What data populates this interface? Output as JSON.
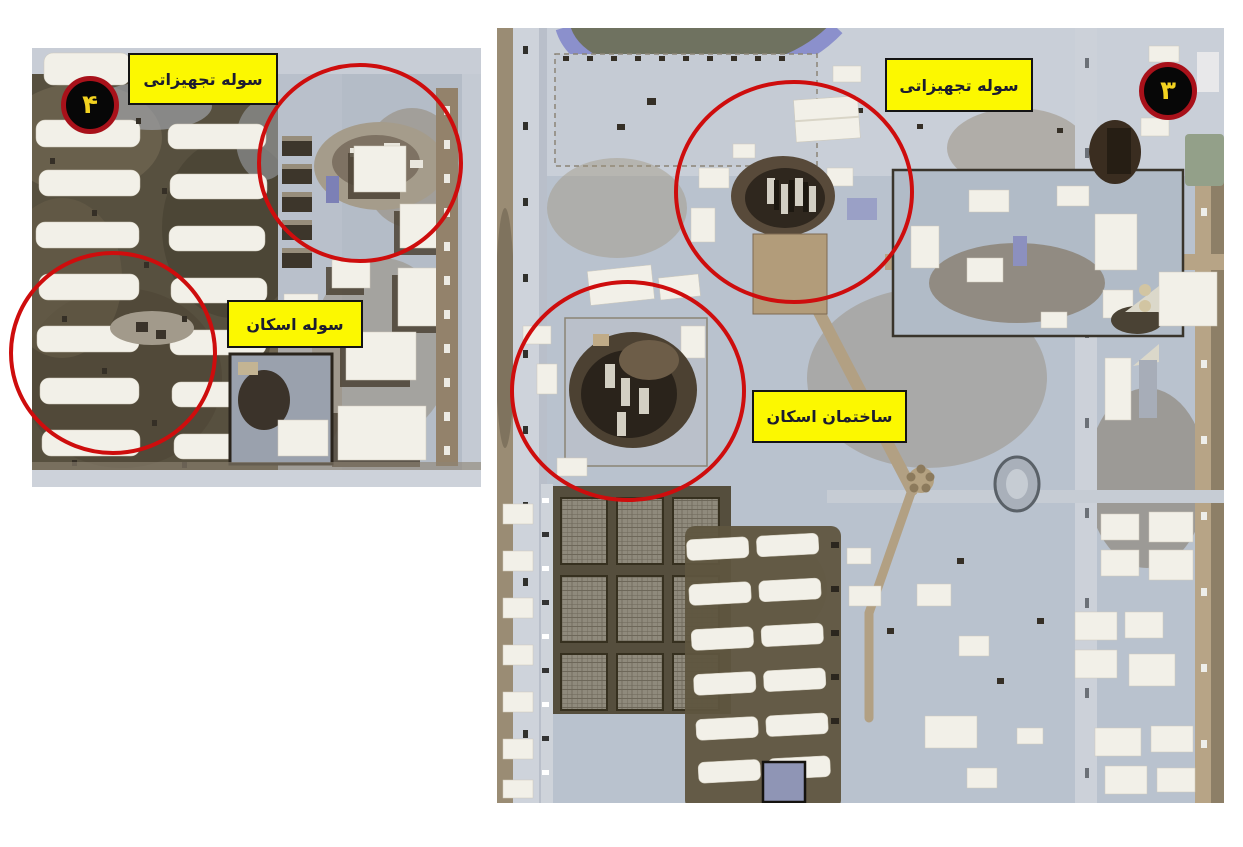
{
  "page": {
    "title": "Annotated satellite imagery of struck base facilities",
    "background": "#ffffff"
  },
  "panels": {
    "left": {
      "marker": {
        "number": "۴"
      },
      "labels": [
        {
          "text": "سوله تجهیزاتی"
        },
        {
          "text": "سوله اسکان"
        }
      ]
    },
    "right": {
      "marker": {
        "number": "۳"
      },
      "labels": [
        {
          "text": "سوله تجهیزاتی"
        },
        {
          "text": "ساختمان اسکان"
        }
      ]
    }
  },
  "colors": {
    "label_background": "#fcf800",
    "label_border": "#141414",
    "label_text": "#1c1c30",
    "annotation_circle": "#ce0d0d",
    "badge_background": "#070707",
    "badge_ring": "#a8111a",
    "badge_number": "#f2d220"
  }
}
